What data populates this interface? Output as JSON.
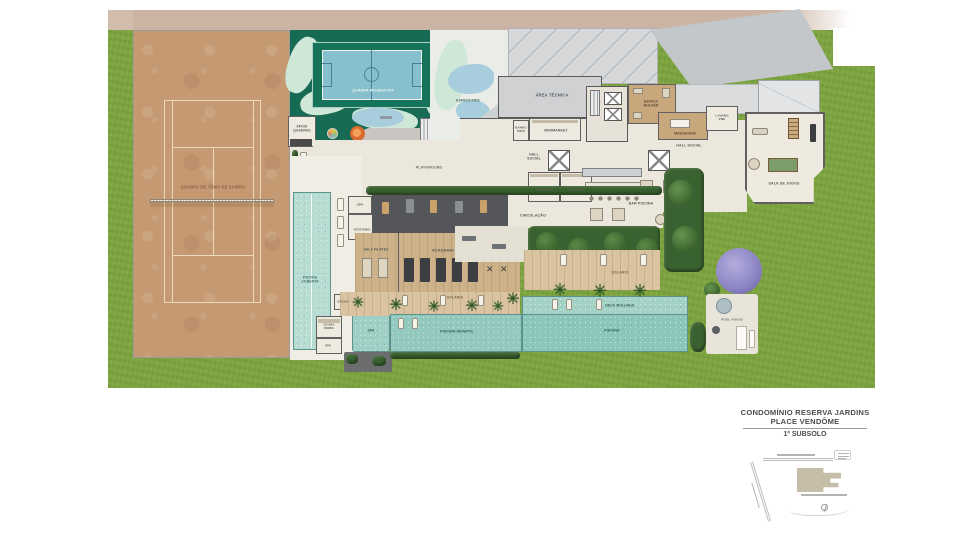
{
  "plan": {
    "labels": {
      "tennis": "QUADRA DE TÊNIS DE SAIBRO",
      "quadra_recreativa": "QUADRA RECREATIVA",
      "apoio_quadras": "APOIO QUADRAS",
      "espaco_kids": "ESPAÇO KIDS",
      "playground": "PLAYGROUND",
      "area_tecnica": "ÁREA TÉCNICA",
      "banho_kids": "BANHO KIDS",
      "minimarket": "MINIMARKET",
      "espaco_mulher": "ESPAÇO MULHER",
      "massagem": "MASSAGEM",
      "lavabo_pne": "LAVABO PNE",
      "hall_social": "HALL SOCIAL",
      "hall_social_2": "HALL SOCIAL",
      "sala_de_jogos": "SALA DE JOGOS",
      "vestiario_1": "VESTIÁRIO",
      "vestiario_2": "VESTIÁRIO",
      "bar_piscina": "BAR PISCINA",
      "circulacao": "CIRCULAÇÃO",
      "spa": "SPA",
      "vestiario_spa": "VESTIÁRIO",
      "sala_pilates": "SALA PILATES",
      "academia": "ACADEMIA",
      "piscina_coberta": "PISCINA COBERTA",
      "ducha": "DUCHA",
      "sauna_umida": "SAUNA ÚMIDA",
      "spa_2": "SPA",
      "spa_pool": "SPA",
      "solario": "SOLÁRIO",
      "piscina_infantil": "PISCINA INFANTIL",
      "solario_2": "SOLÁRIO",
      "deck_molhado": "DECK MOLHADO",
      "piscina": "PISCINA",
      "pool_house": "POOL HOUSE"
    },
    "colors": {
      "lawn": "#7ea43f",
      "clay": "#c59a72",
      "court_green": "#176a54",
      "court_blue": "#87bfcc",
      "pool": "#8fc7bb",
      "roof": "#d6d8da",
      "floor": "#ece7dc",
      "hedge": "#3a6130",
      "deck_wood": "#d9c3a0",
      "purple_tree": "#9a93cf",
      "site_band": "#cbb4a4"
    }
  },
  "title_block": {
    "line1": "CONDOMÍNIO RESERVA JARDINS",
    "line2": "PLACE VENDÔME",
    "floor": "1º SUBSOLO"
  }
}
